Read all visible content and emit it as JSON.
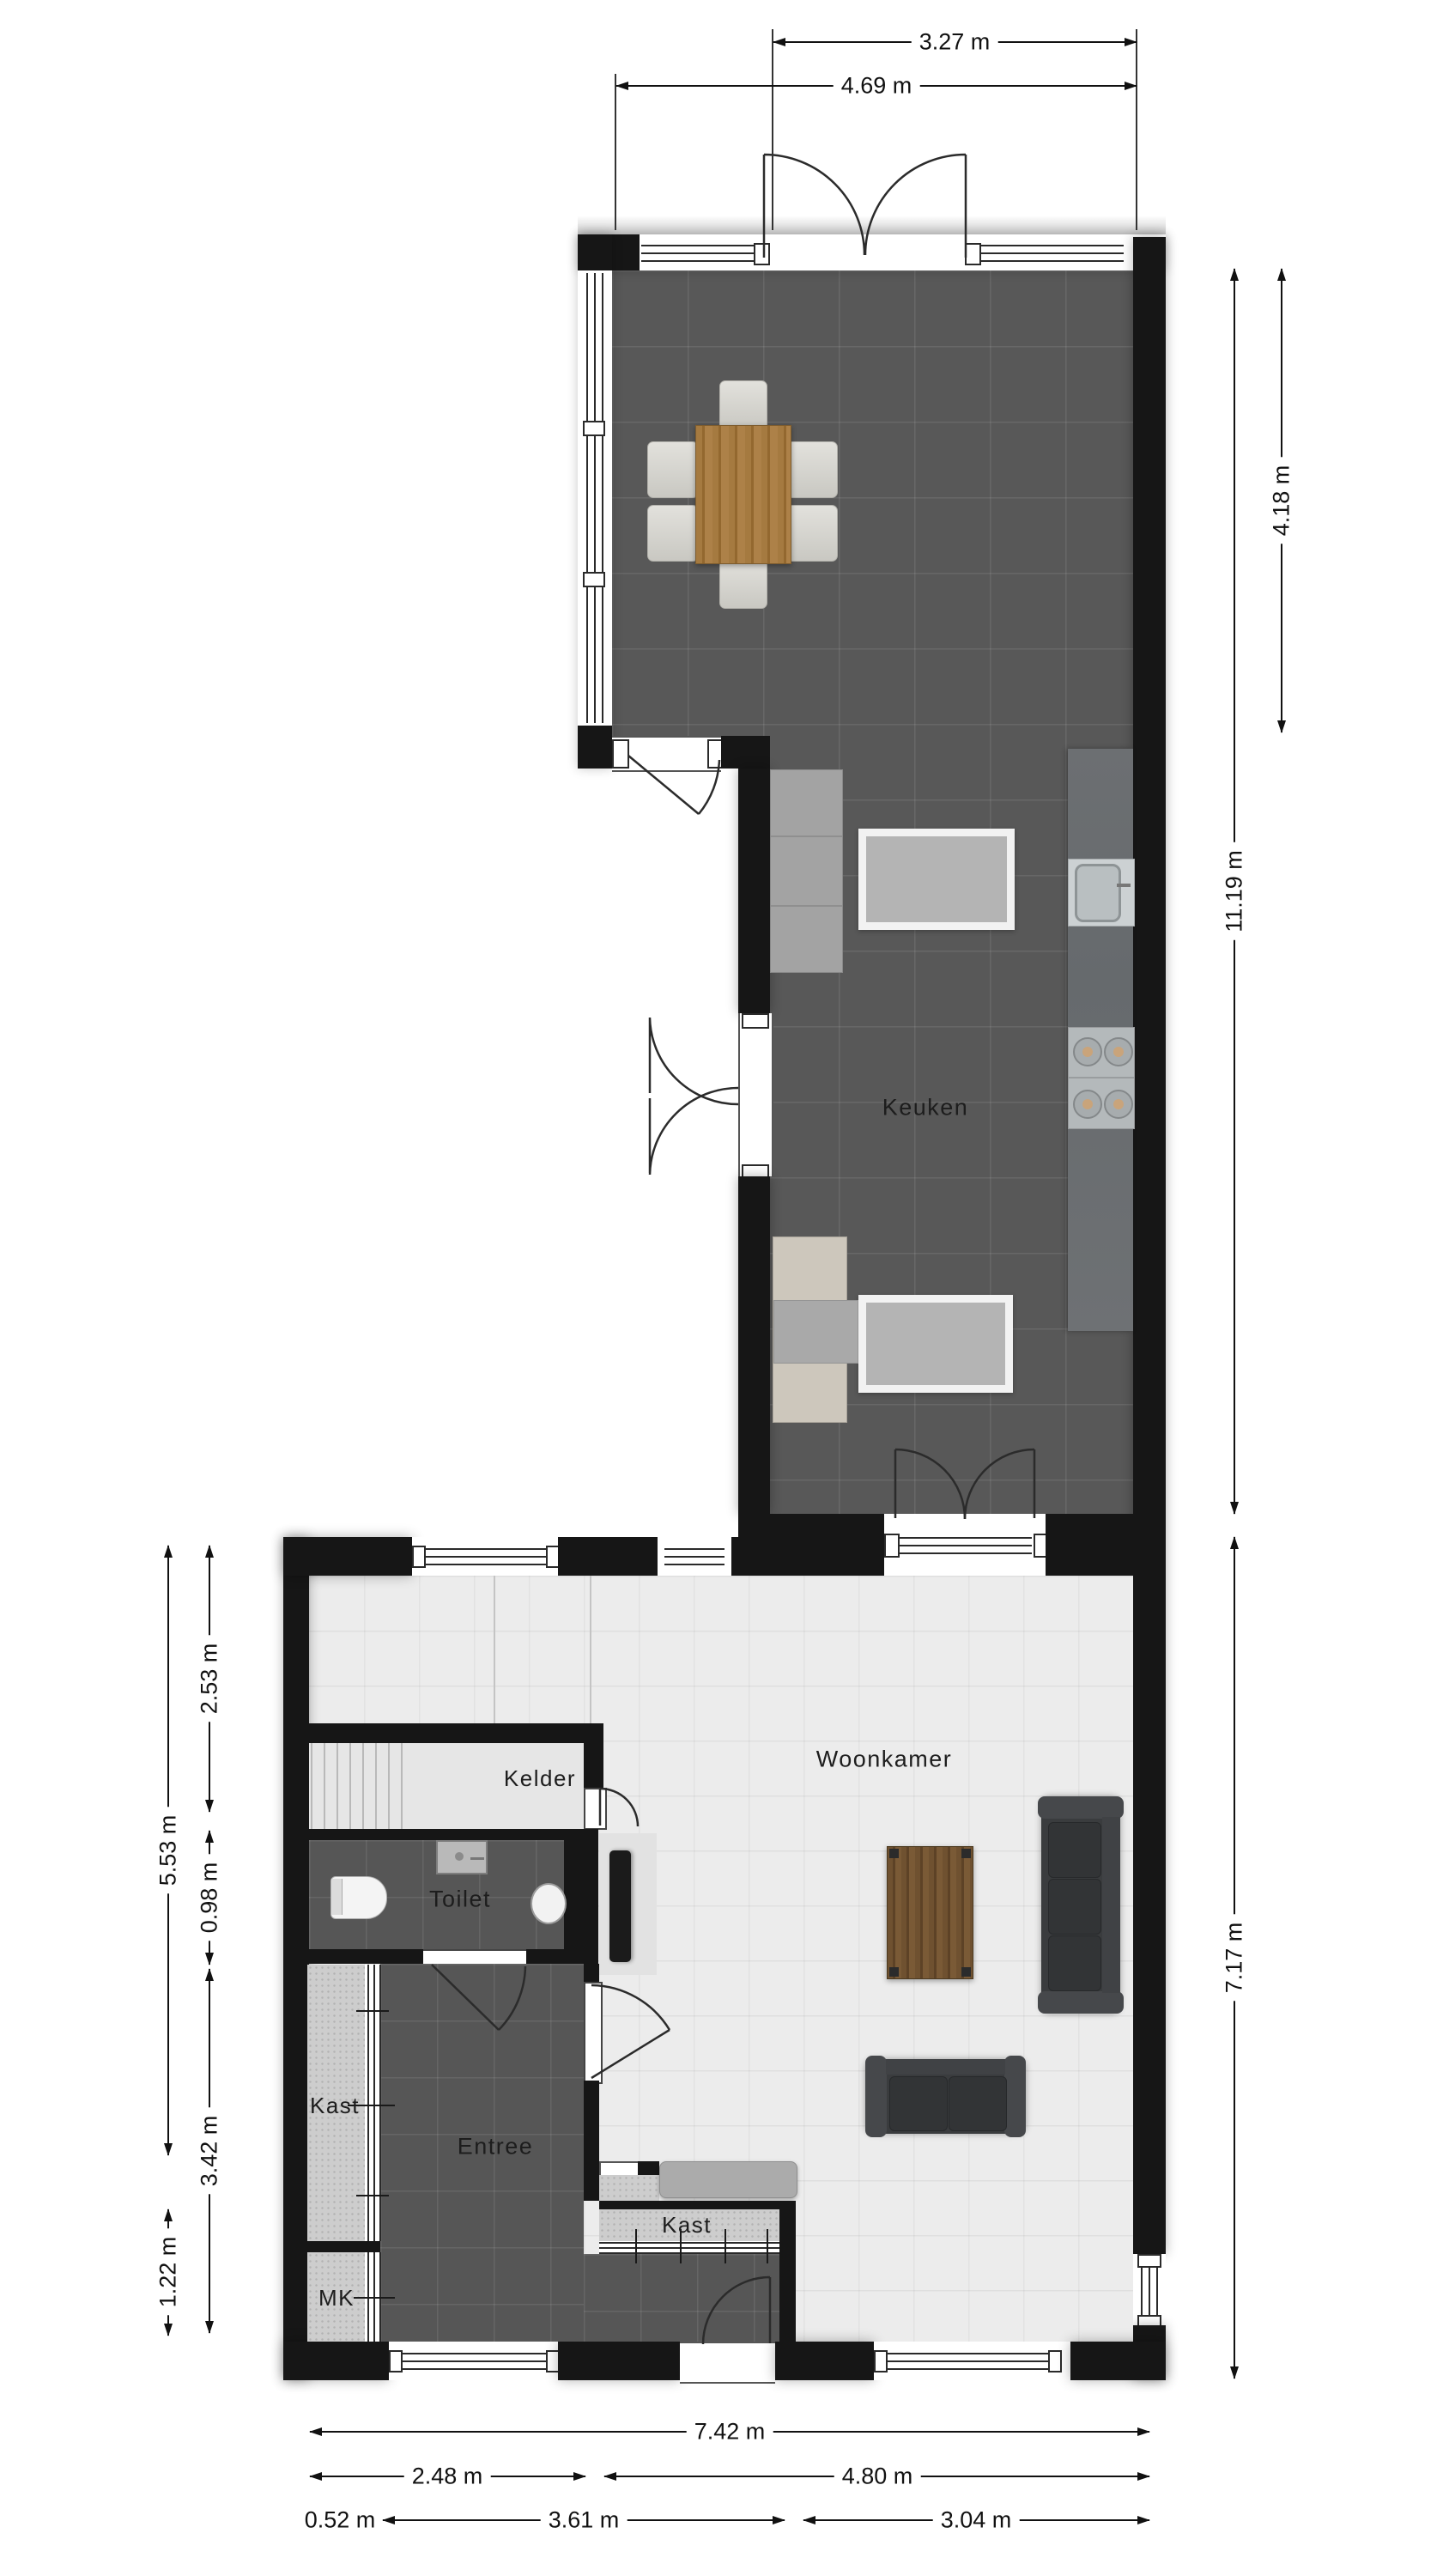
{
  "plan": {
    "rooms": {
      "keuken": "Keuken",
      "woonkamer": "Woonkamer",
      "kelder": "Kelder",
      "toilet": "Toilet",
      "kast_left": "Kast",
      "entree": "Entree",
      "mk": "MK",
      "kast_bottom": "Kast"
    },
    "dimensions": {
      "top_inner": "3.27 m",
      "top_outer": "4.69 m",
      "right_upper": "4.18 m",
      "right_full": "11.19 m",
      "right_lower": "7.17 m",
      "left_inner_upper": "2.53 m",
      "left_outer_upper": "5.53 m",
      "left_inner_mid": "0.98 m",
      "left_inner_lower": "3.42 m",
      "left_outer_lower": "1.22 m",
      "bottom_full": "7.42 m",
      "bottom_left": "2.48 m",
      "bottom_right": "4.80 m",
      "bottom_small": "0.52 m",
      "bottom_mid": "3.61 m",
      "bottom_far_right": "3.04 m"
    },
    "colors": {
      "wall": "#161616",
      "kitchen_floor": "#585858",
      "living_floor": "#ececec",
      "island": "#6d7073",
      "dining_table_wood": "#a57a40",
      "coffee_table_wood": "#6f5130",
      "sofa": "#3a3c3e"
    }
  }
}
